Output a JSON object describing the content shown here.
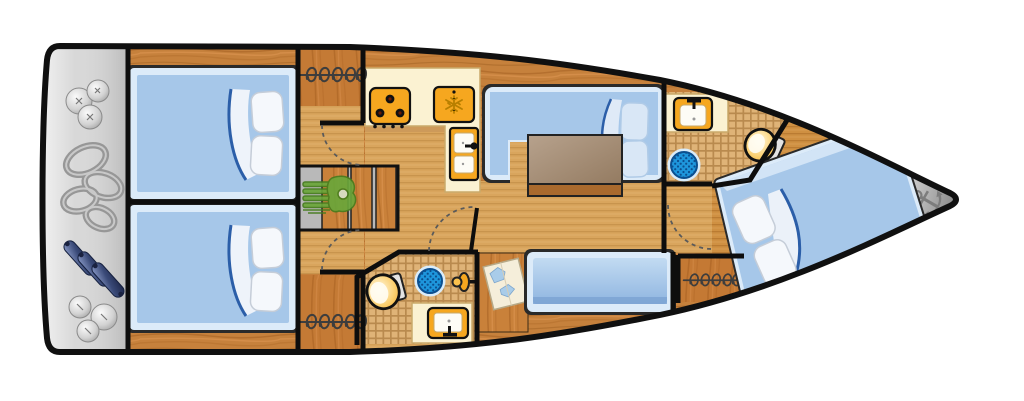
{
  "plan": {
    "kind": "sailboat-interior-deck-plan",
    "orientation": "bow-right",
    "rooms": [
      "stern-storage",
      "aft-cabin-port",
      "aft-cabin-starboard",
      "companionway",
      "galley",
      "salon-dinette",
      "forward-head",
      "aft-head",
      "nav-station",
      "salon-bench",
      "bow-cabin",
      "anchor-locker"
    ]
  },
  "icons": {
    "anchor": "⚓",
    "stove": "three-burner-cooktop",
    "fridge": "snowflake-cooler",
    "sink": "basin-with-faucet",
    "shower": "round-drain-grate",
    "toilet": "marine-toilet",
    "wardrobe": "hanging-rail-coils",
    "engine": "engine-block",
    "fenders": "round-and-cylindrical-fenders",
    "ropes": "coiled-dock-lines",
    "chart": "nav-chart"
  },
  "colors": {
    "hull_outline": "#101010",
    "stern_platform": "#d6d6d6",
    "wood_dark": "#c6813c",
    "floor_light": "#d9a55d",
    "counter": "#fbf2d2",
    "appliance": "#f6a71f",
    "bed_fill": "#a6c7e9",
    "bed_frame": "#dcebf9",
    "navy": "#2b5ea8",
    "shower": "#1e96dc",
    "engine": "#6aa63a",
    "anchor": "#7d7d7d",
    "wall": "#0d0d0d"
  }
}
